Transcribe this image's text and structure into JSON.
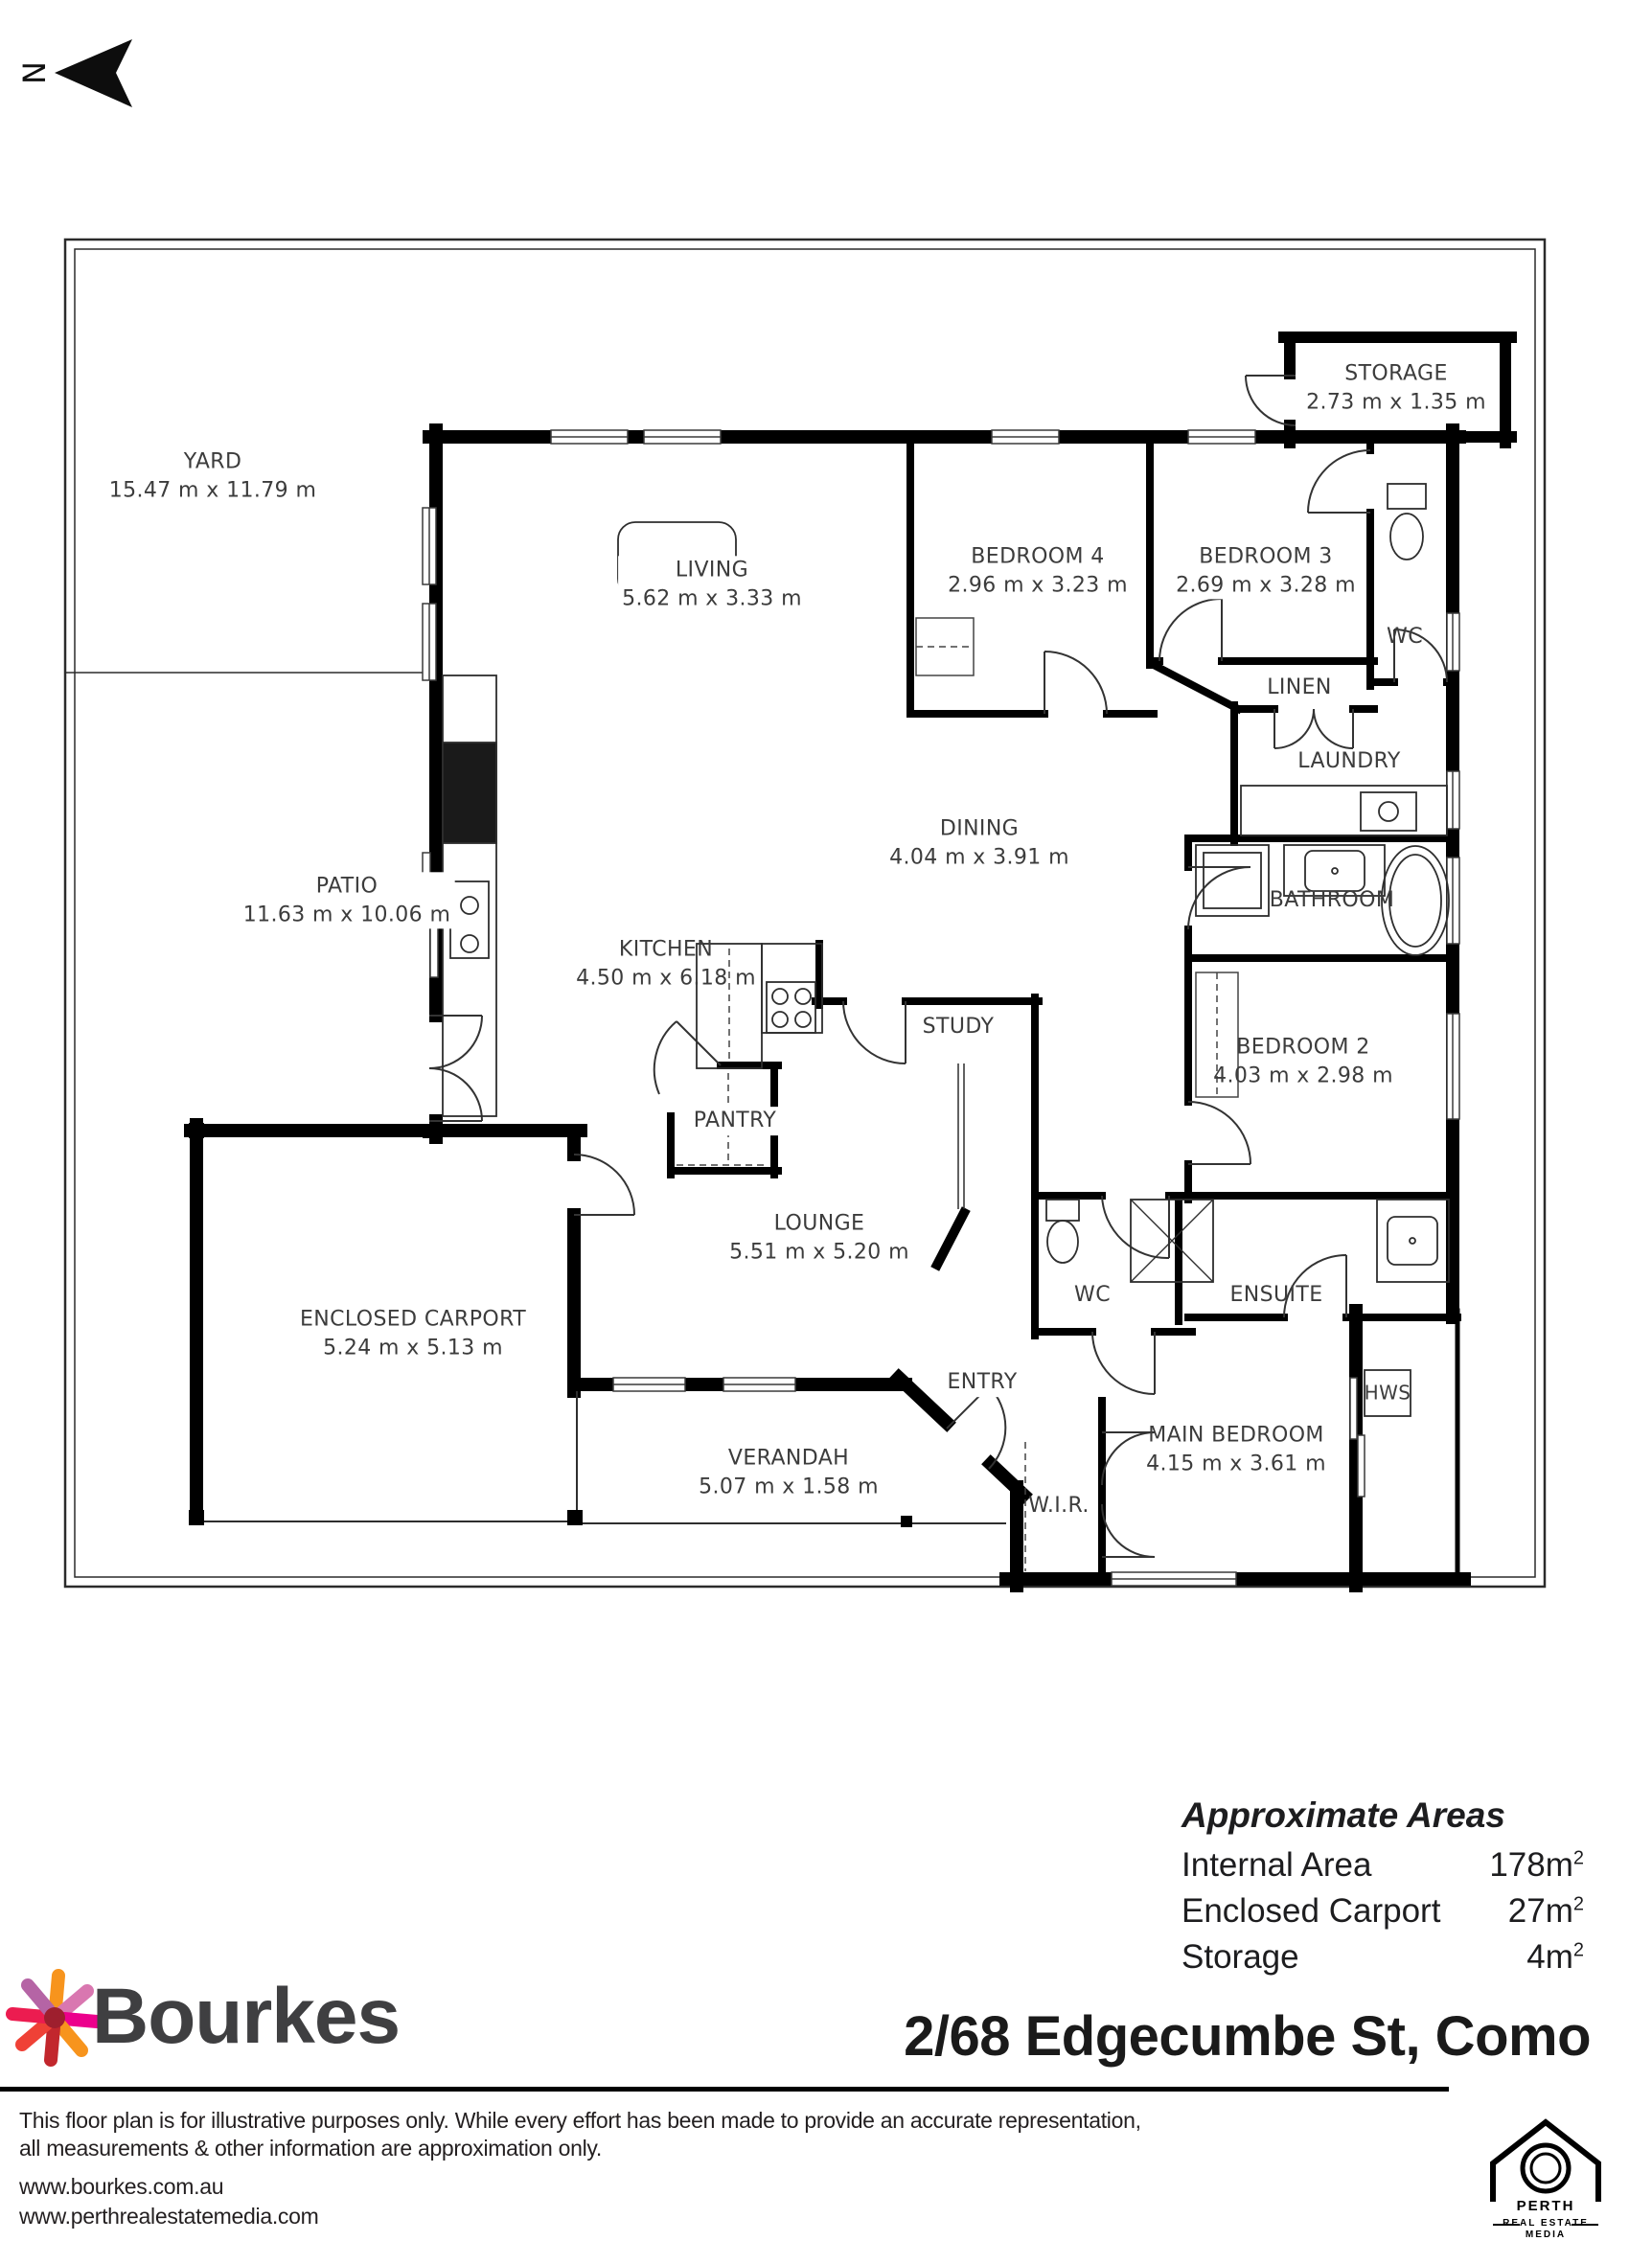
{
  "north_indicator": {
    "label": "N"
  },
  "plan": {
    "rooms": [
      {
        "name": "YARD",
        "dims": "15.47 m x 11.79 m"
      },
      {
        "name": "PATIO",
        "dims": "11.63 m x 10.06 m"
      },
      {
        "name": "LIVING",
        "dims": "5.62 m x 3.33 m"
      },
      {
        "name": "BEDROOM 4",
        "dims": "2.96 m x 3.23 m"
      },
      {
        "name": "BEDROOM 3",
        "dims": "2.69 m x 3.28 m"
      },
      {
        "name": "STORAGE",
        "dims": "2.73 m x 1.35 m"
      },
      {
        "name": "WC",
        "dims": ""
      },
      {
        "name": "LINEN",
        "dims": ""
      },
      {
        "name": "LAUNDRY",
        "dims": ""
      },
      {
        "name": "DINING",
        "dims": "4.04 m x 3.91 m"
      },
      {
        "name": "KITCHEN",
        "dims": "4.50 m x 6.18 m"
      },
      {
        "name": "BATHROOM",
        "dims": ""
      },
      {
        "name": "STUDY",
        "dims": ""
      },
      {
        "name": "PANTRY",
        "dims": ""
      },
      {
        "name": "BEDROOM 2",
        "dims": "4.03 m x 2.98 m"
      },
      {
        "name": "LOUNGE",
        "dims": "5.51 m x 5.20 m"
      },
      {
        "name": "WC",
        "dims": ""
      },
      {
        "name": "ENSUITE",
        "dims": ""
      },
      {
        "name": "ENCLOSED CARPORT",
        "dims": "5.24 m x 5.13 m"
      },
      {
        "name": "ENTRY",
        "dims": ""
      },
      {
        "name": "MAIN BEDROOM",
        "dims": "4.15 m x 3.61 m"
      },
      {
        "name": "HWS",
        "dims": ""
      },
      {
        "name": "VERANDAH",
        "dims": "5.07 m x 1.58 m"
      },
      {
        "name": "W.I.R.",
        "dims": ""
      }
    ]
  },
  "areas": {
    "title": "Approximate Areas",
    "rows": [
      {
        "label": "Internal Area",
        "value": "178m",
        "sup": "2"
      },
      {
        "label": "Enclosed Carport",
        "value": "27m",
        "sup": "2"
      },
      {
        "label": "Storage",
        "value": "4m",
        "sup": "2"
      }
    ]
  },
  "branding": {
    "agency": "Bourkes",
    "address": "2/68 Edgecumbe St, Como",
    "accent_colors": [
      "#F7941D",
      "#EC008C",
      "#C2272D",
      "#B564A5",
      "#EF4136"
    ]
  },
  "footer": {
    "disclaimer_line1": "This floor plan is for illustrative purposes only. While every effort has been made to provide an accurate representation,",
    "disclaimer_line2": "all measurements & other information are approximation only.",
    "website1": "www.bourkes.com.au",
    "website2": "www.perthrealestatemedia.com"
  },
  "media_logo": {
    "line1": "PERTH",
    "line2": "REAL ESTATE",
    "line3": "MEDIA"
  }
}
